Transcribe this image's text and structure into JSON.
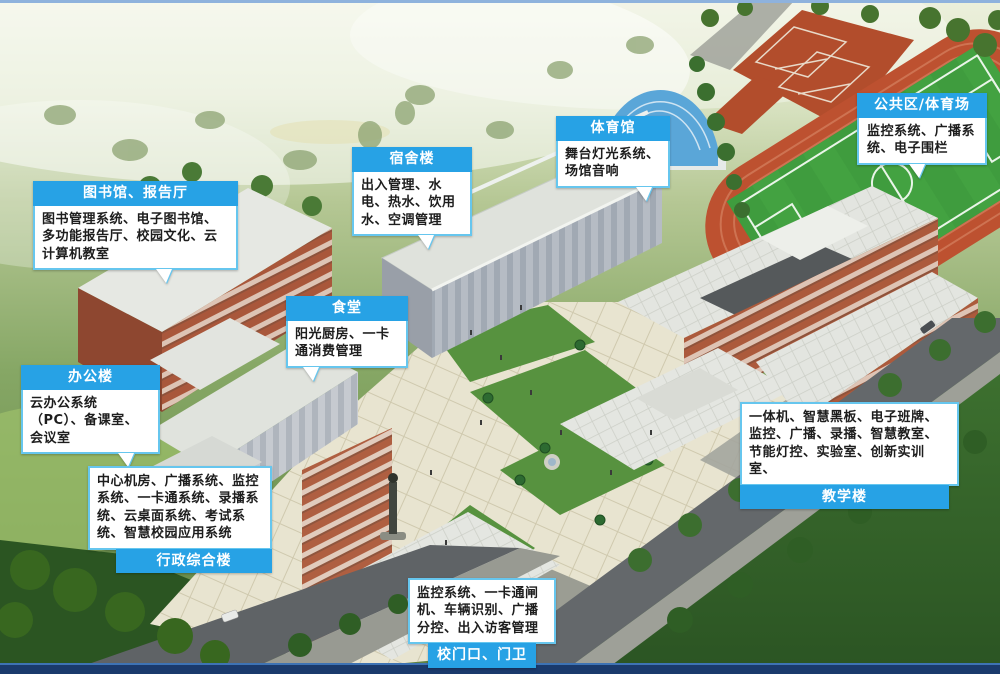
{
  "scene": {
    "description": "aerial rendering of a smart school campus with system callouts",
    "colors": {
      "callout_header_blue": "#27A2E5",
      "callout_border_blue": "#66C6EE",
      "callout_body_bg": "#FFFFFF",
      "callout_text": "#1D1D1D",
      "header_text": "#FFFFFF",
      "track_red": "#BD5130",
      "pitch_green": "#3F9C3E",
      "court_red": "#B24D2C",
      "plaza_cream": "#E8E4D0",
      "brick": "#AC5A3C",
      "road_gray": "#64686B",
      "top_edge_line": "#8EB2DD",
      "bottom_bar_navy": "#1A3A6C"
    }
  },
  "callouts": [
    {
      "id": "library",
      "title": "图书馆、报告厅",
      "body": "图书管理系统、电子图书馆、多功能报告厅、校园文化、云计算机教室"
    },
    {
      "id": "dormitory",
      "title": "宿舍楼",
      "body": "出入管理、水电、热水、饮用水、空调管理"
    },
    {
      "id": "gym",
      "title": "体育馆",
      "body": "舞台灯光系统、场馆音响"
    },
    {
      "id": "public-stadium",
      "title": "公共区/体育场",
      "body": "监控系统、广播系统、电子围栏"
    },
    {
      "id": "canteen",
      "title": "食堂",
      "body": "阳光厨房、一卡通消费管理"
    },
    {
      "id": "office",
      "title": "办公楼",
      "body": "云办公系统（PC）、备课室、会议室"
    },
    {
      "id": "admin",
      "title": "行政综合楼",
      "body": "中心机房、广播系统、监控系统、一卡通系统、录播系统、云桌面系统、考试系统、智慧校园应用系统"
    },
    {
      "id": "teaching",
      "title": "教学楼",
      "body": "一体机、智慧黑板、电子班牌、监控、广播、录播、智慧教室、节能灯控、实验室、创新实训室、"
    },
    {
      "id": "gate",
      "title": "校门口、门卫",
      "body": "监控系统、一卡通闸机、车辆识别、广播分控、出入访客管理"
    }
  ]
}
